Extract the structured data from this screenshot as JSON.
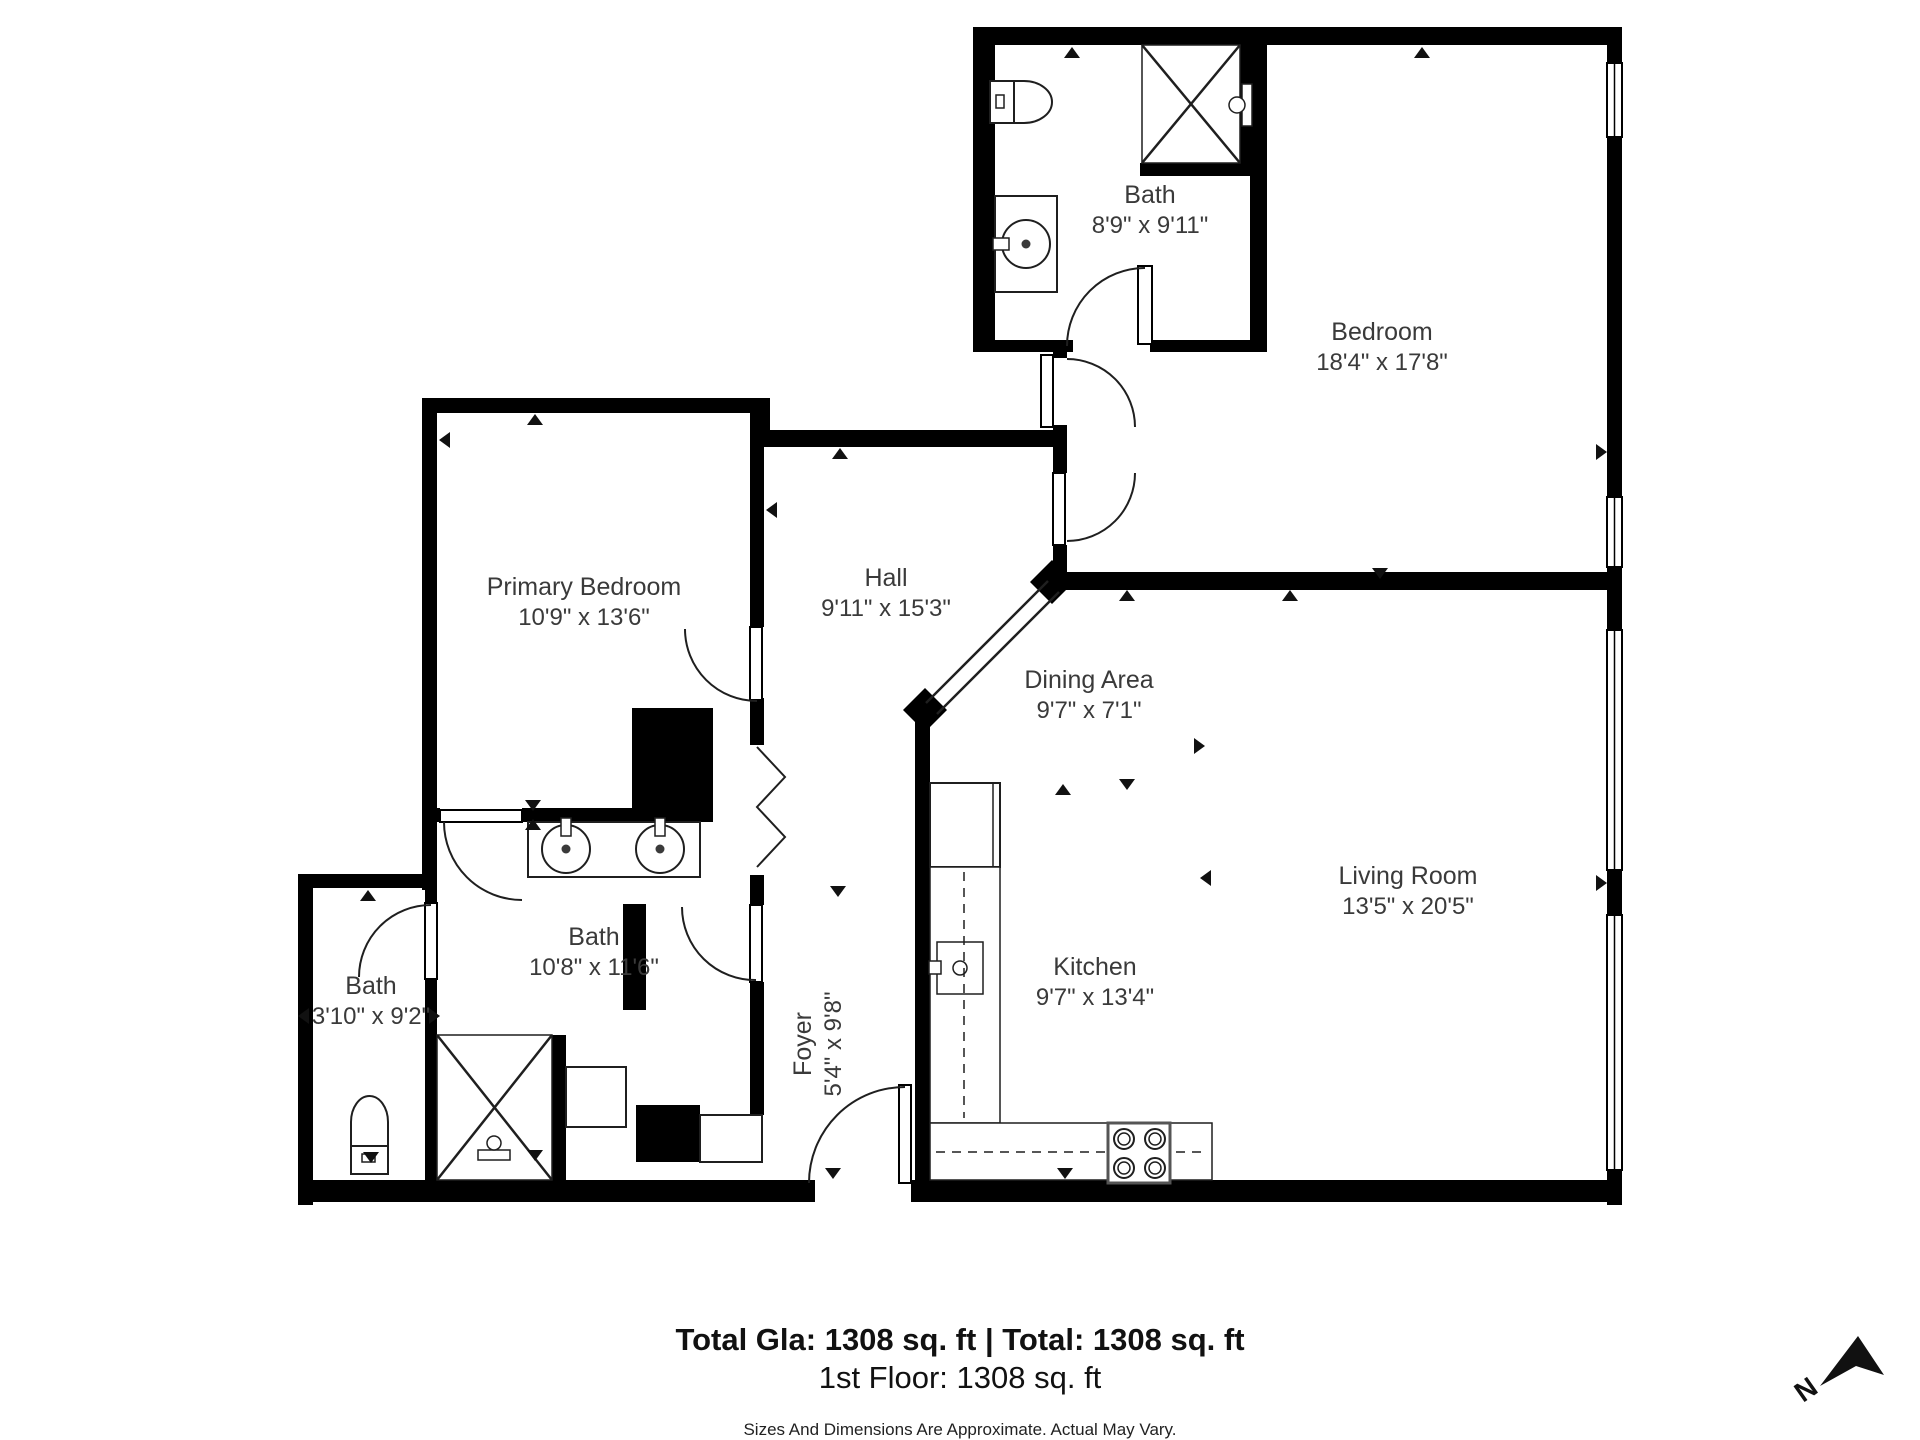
{
  "rooms": {
    "bath_top": {
      "label": "Bath",
      "dims": "8'9\" x 9'11\""
    },
    "bedroom": {
      "label": "Bedroom",
      "dims": "18'4\" x 17'8\""
    },
    "primary_bedroom": {
      "label": "Primary Bedroom",
      "dims": "10'9\" x 13'6\""
    },
    "hall": {
      "label": "Hall",
      "dims": "9'11\" x 15'3\""
    },
    "dining": {
      "label": "Dining Area",
      "dims": "9'7\" x 7'1\""
    },
    "living": {
      "label": "Living Room",
      "dims": "13'5\" x 20'5\""
    },
    "kitchen": {
      "label": "Kitchen",
      "dims": "9'7\" x 13'4\""
    },
    "bath_main": {
      "label": "Bath",
      "dims": "10'8\" x 11'6\""
    },
    "bath_small": {
      "label": "Bath",
      "dims": "3'10\" x 9'2\""
    },
    "foyer": {
      "label": "Foyer",
      "dims": "5'4\" x 9'8\""
    }
  },
  "footer": {
    "totals": "Total Gla: 1308 sq. ft | Total: 1308 sq. ft",
    "floor": "1st Floor: 1308 sq. ft",
    "disclaimer": "Sizes And Dimensions Are Approximate. Actual May Vary."
  },
  "compass": {
    "north_label": "N"
  },
  "colors": {
    "wall": "#000000",
    "line": "#1f1f1f",
    "text": "#3a3a3a"
  }
}
